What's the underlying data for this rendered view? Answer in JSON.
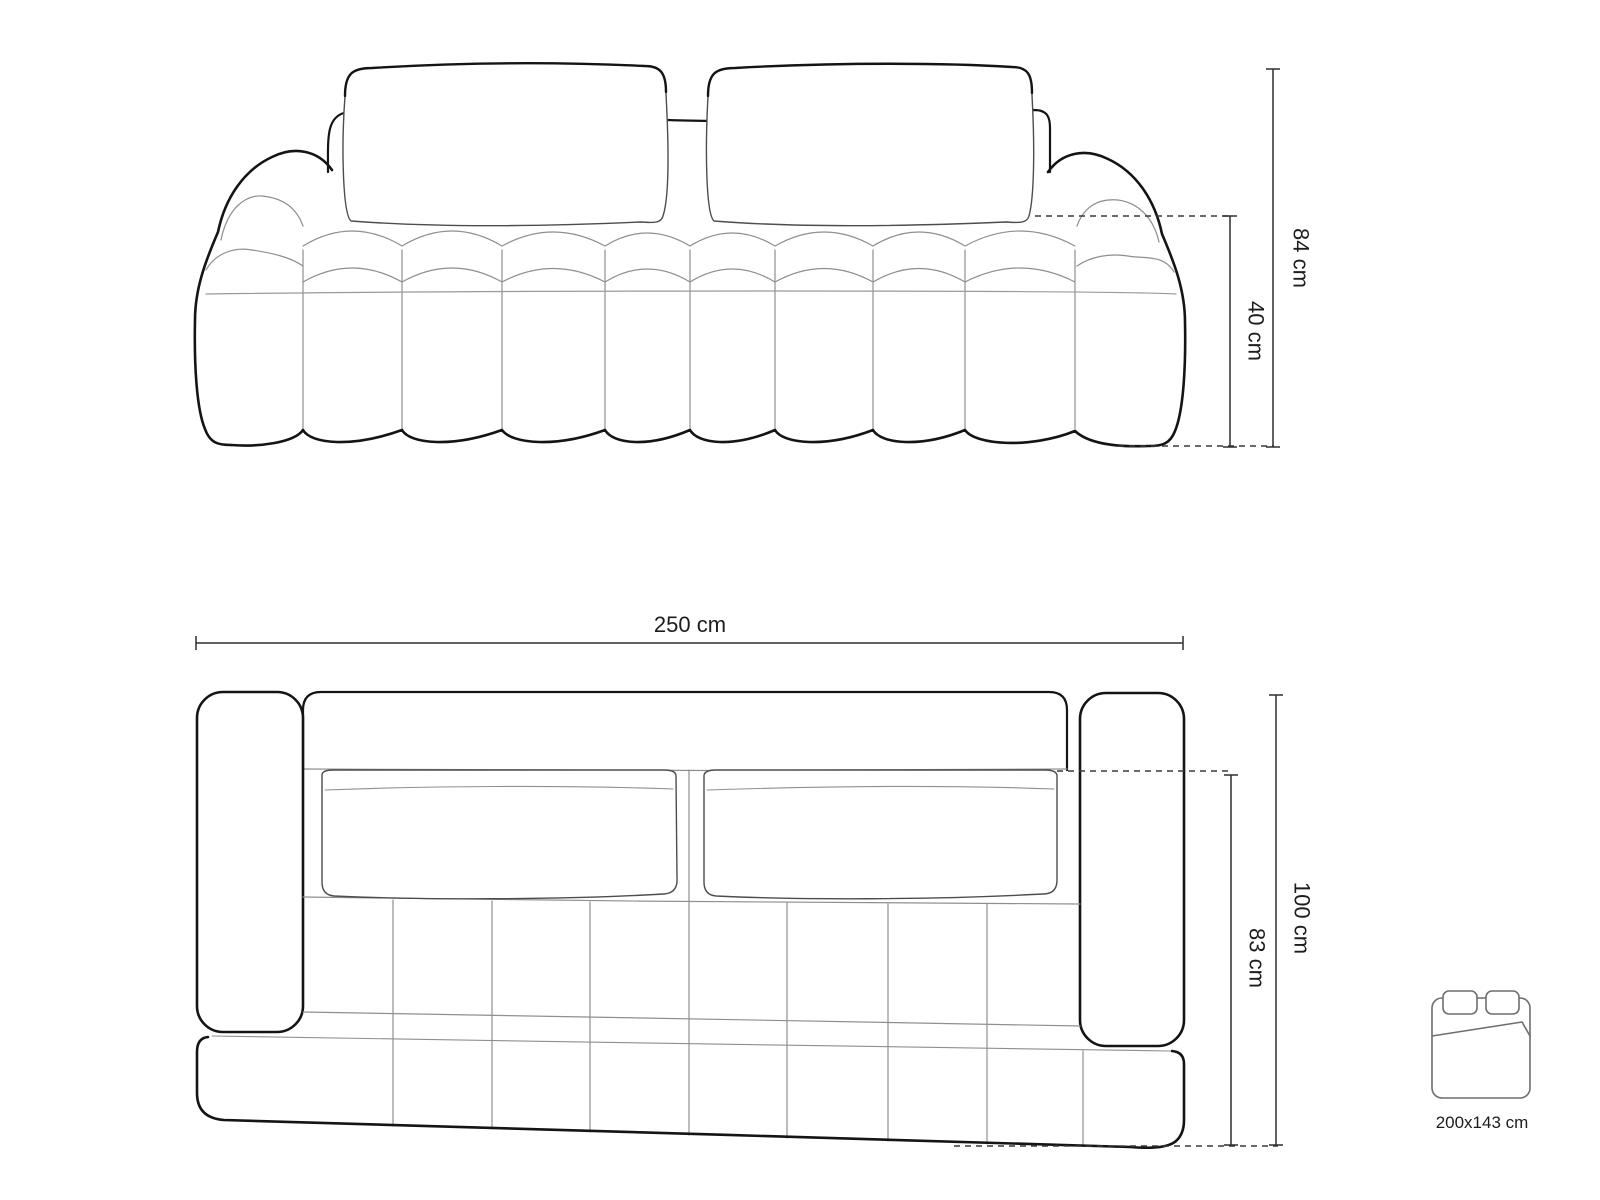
{
  "diagram": {
    "title_context": "sofa-dimension-drawing",
    "front_view": {
      "overall_height_label": "84 cm",
      "seat_height_label": "40 cm"
    },
    "top_view": {
      "overall_width_label": "250 cm",
      "overall_depth_label": "100 cm",
      "seat_depth_label": "83 cm"
    },
    "sleeping_function": {
      "size_label": "200x143 cm"
    },
    "colors": {
      "background": "#ffffff",
      "outline": "#141414",
      "detail_line": "#8f8f8f",
      "medium_line": "#4d4d4d",
      "dimension_line": "#2e2e2e"
    }
  }
}
